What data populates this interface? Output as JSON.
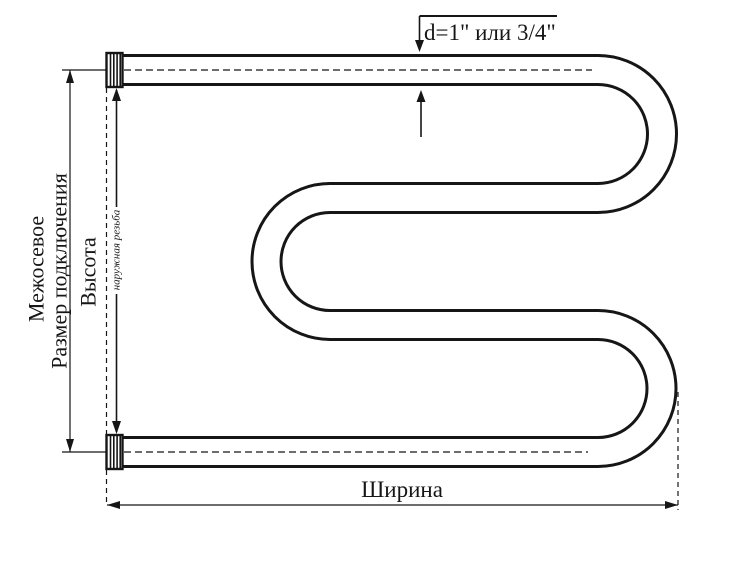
{
  "page": {
    "background": "#ffffff",
    "line_color": "#161616"
  },
  "diagram": {
    "type": "dimensional technical drawing",
    "subject": "M-shaped pipe towel rail with threaded connections",
    "labels": {
      "diameter": "d=1\" или 3/4\"",
      "interaxial_line1": "Межосевое",
      "interaxial_line2": "Размер подключения",
      "height": "Высота",
      "thread": "наружная резьба",
      "width": "Ширина"
    }
  }
}
